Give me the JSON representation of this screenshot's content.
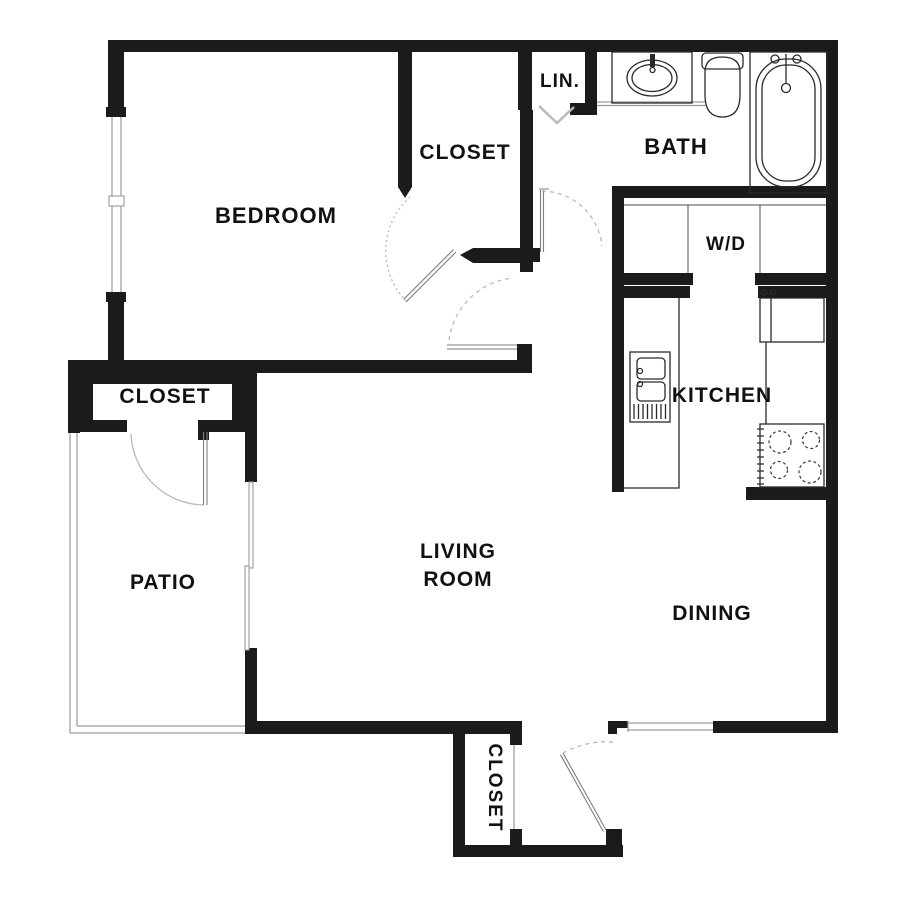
{
  "floorplan": {
    "labels": {
      "bedroom": "BEDROOM",
      "bedroom_closet": "CLOSET",
      "linen": "LIN.",
      "bath": "BATH",
      "washer_dryer": "W/D",
      "kitchen": "KITCHEN",
      "hall_closet": "CLOSET",
      "patio": "PATIO",
      "living_room_line1": "LIVING",
      "living_room_line2": "ROOM",
      "dining": "DINING",
      "entry_closet": "CLOSET"
    },
    "colors": {
      "wall": "#1b1b1b",
      "fixture_line": "#2a2a2a",
      "light_line": "#9a9a9a",
      "arc_line": "#b9b9b9",
      "text": "#111111",
      "background": "#ffffff"
    }
  }
}
